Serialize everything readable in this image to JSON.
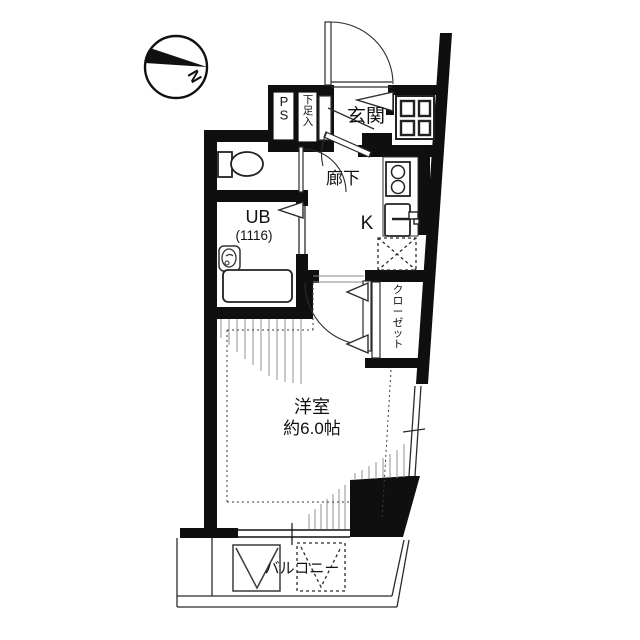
{
  "compass": {
    "north_label": "N"
  },
  "labels": {
    "entrance": "玄関",
    "hallway": "廊下",
    "kitchen": "K",
    "unit_bath": "UB",
    "unit_bath_size": "(1116)",
    "pipe_space": "PS",
    "shoe_cabinet": "下足入",
    "closet": "クローゼット",
    "western_room": "洋室",
    "western_room_size": "約6.0帖",
    "balcony": "バルコニー"
  },
  "colors": {
    "wall": "#0f0f0f",
    "line": "#2b2b2b",
    "hatch": "#9a9a9a",
    "background": "#ffffff"
  }
}
